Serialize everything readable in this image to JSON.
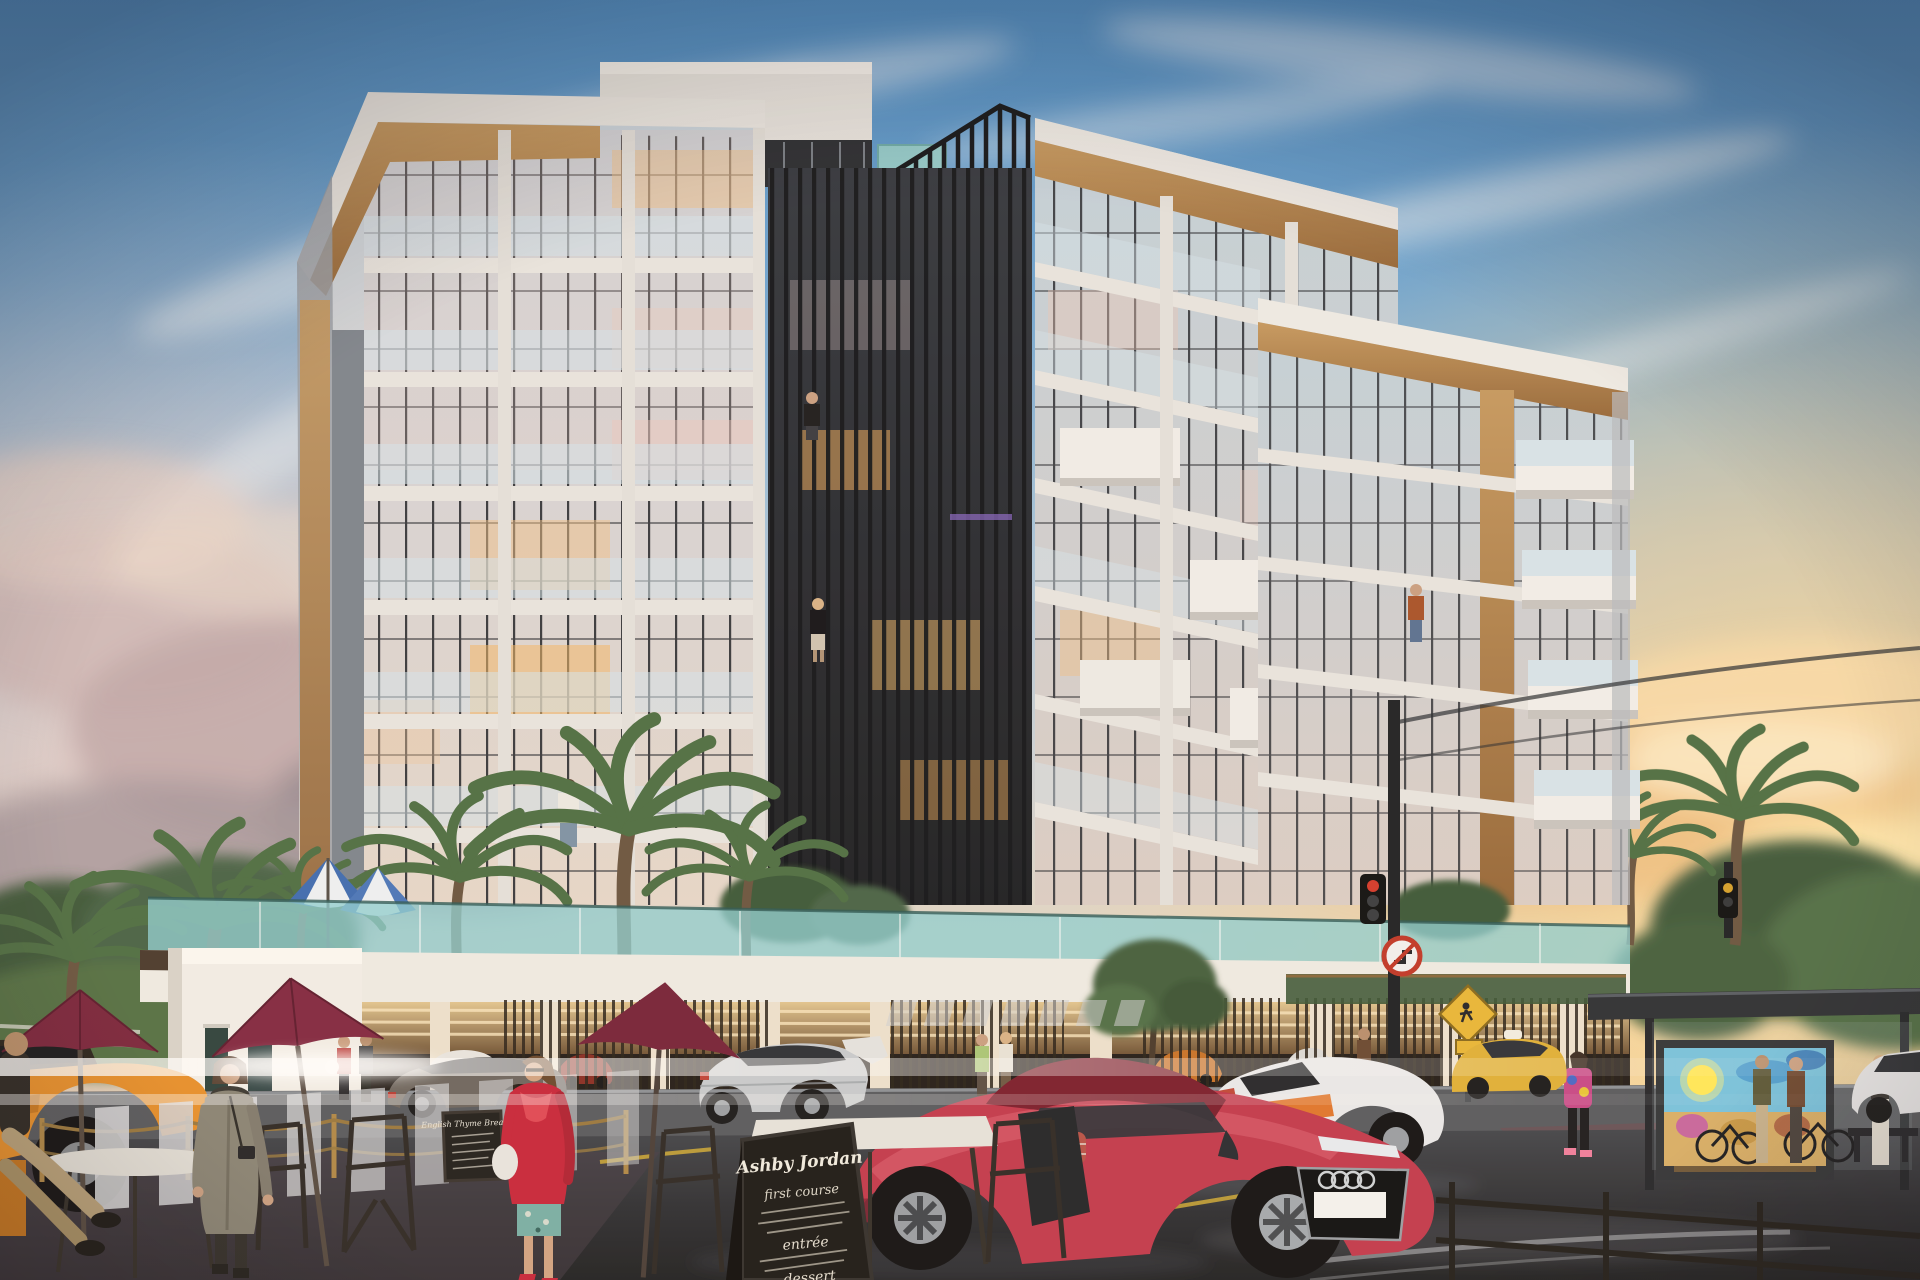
{
  "scene": {
    "type": "architectural-exterior-rendering",
    "time_of_day": "sunset",
    "description": "Photorealistic render of a modern 8-storey apartment building with two white towers, a dark vertical-fin feature between them, glass balconies, wood accents, a landscaped podium terrace with palms, street-level cafe, vehicles and pedestrians at dusk"
  },
  "building": {
    "storeys": 8,
    "features": [
      "white concrete frame",
      "floor-to-ceiling glazing with black mullions",
      "glass balustrade balconies",
      "timber fascia and soffit accents",
      "black vertical fin crown above central core",
      "rooftop glass railing",
      "podium terrace with palms and striped pool umbrellas",
      "open parking colonnade with warm lighting and bronze slat screens"
    ]
  },
  "cafe": {
    "umbrella_color": "#7c2840",
    "menu_board": {
      "title": "Ashby Jordan",
      "sections": [
        "first course",
        "entrée",
        "dessert"
      ]
    },
    "small_board_title": "English Thyme Breakfast"
  },
  "vehicles": [
    {
      "label": "red Audi R8 coupe with driver",
      "color": "#c23b50"
    },
    {
      "label": "white Lamborghini with orange side band",
      "color": "#e9eaec"
    },
    {
      "label": "silver BMW X6",
      "color": "#c8ccd0"
    },
    {
      "label": "gray sedan passing entrance",
      "color": "#6e6862"
    },
    {
      "label": "orange taxi foreground left",
      "color": "#e6912f"
    },
    {
      "label": "yellow taxi behind bus stop",
      "color": "#e0b23a"
    },
    {
      "label": "white sedan far right",
      "color": "#e6e7e9"
    },
    {
      "label": "parked cars inside podium garage",
      "color": "#8a4a3a"
    }
  ],
  "people": [
    "man in black tee on upper balcony",
    "woman on mid-level balcony",
    "man in white shirt on first-floor balcony",
    "man in rust jacket on right tower balcony",
    "couple walking past entrance",
    "two women walking on sidewalk",
    "man standing by slat screen",
    "woman in tie-dye hoodie at bus stop",
    "two women waiting beside bus shelter",
    "seated cafe patron at far left",
    "woman in long gray coat with camera walking toward viewer",
    "woman in red jacket with white handbag"
  ],
  "bus_stop": {
    "elements": [
      "dark steel shelter",
      "backlit mural advertisement of beach scene",
      "bench",
      "parked bicycles"
    ]
  },
  "signs": [
    "no-right-turn round sign on signal pole",
    "yellow diamond pedestrian crossing sign",
    "traffic signal heads on black poles with overhead cables"
  ],
  "street": {
    "elements": [
      "wet asphalt road",
      "two zebra crosswalks",
      "yellow lane markings",
      "gold stanchion rope barrier",
      "cafe tables and wire chairs",
      "lens flare light streaks"
    ]
  },
  "palette": {
    "sky_top": "#4c8cc4",
    "sky_mid": "#a8c6dd",
    "sunset_gold": "#f6c878",
    "haze_pink": "#e3c8c6",
    "facade_white": "#eceae6",
    "wood": "#b07c48",
    "glass": "#c6d4de",
    "fins": "#1b1e23",
    "garage_glow": "#f2c98a",
    "balustrade_teal": "#8fd0d4",
    "road": "#2b2d31",
    "umbrella_maroon": "#7c2840",
    "beach_umbrella_blue": "#3f6db4"
  }
}
